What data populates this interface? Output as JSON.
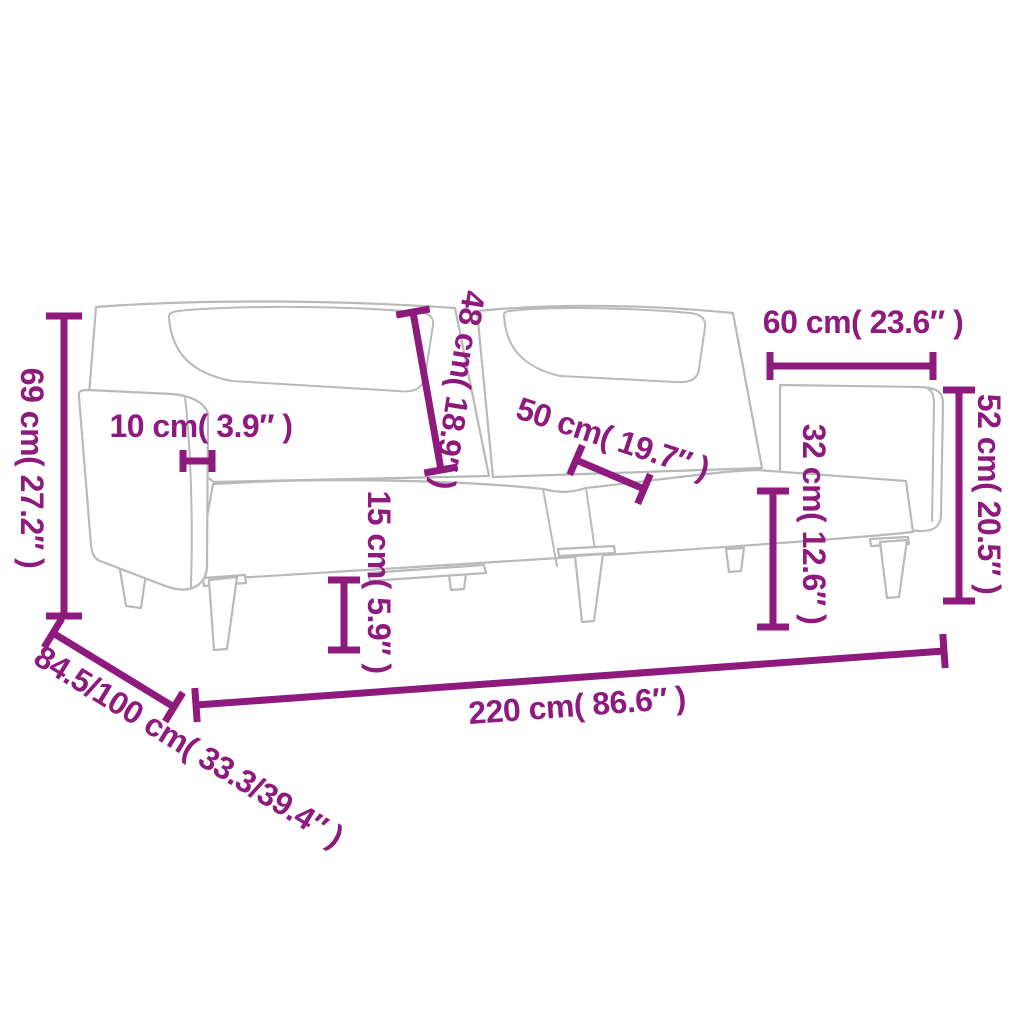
{
  "image": {
    "kind": "sofa-bed dimension diagram",
    "background": "#ffffff"
  },
  "colors": {
    "accent": "#8e1a7d",
    "line_art": "#b9b9b9"
  },
  "labels": {
    "overall_height": "69 cm( 27.2″ )",
    "armrest_thickness": "10 cm( 3.9″ )",
    "backrest_height": "48 cm( 18.9″ )",
    "seat_depth": "50 cm( 19.7″ )",
    "armrest_length": "60 cm( 23.6″ )",
    "armrest_height": "52 cm( 20.5″ )",
    "seat_height": "32 cm( 12.6″ )",
    "leg_height": "15 cm( 5.9″ )",
    "overall_width": "220 cm( 86.6″ )",
    "overall_depth": "84.5/100 cm( 33.3/39.4″ )"
  }
}
